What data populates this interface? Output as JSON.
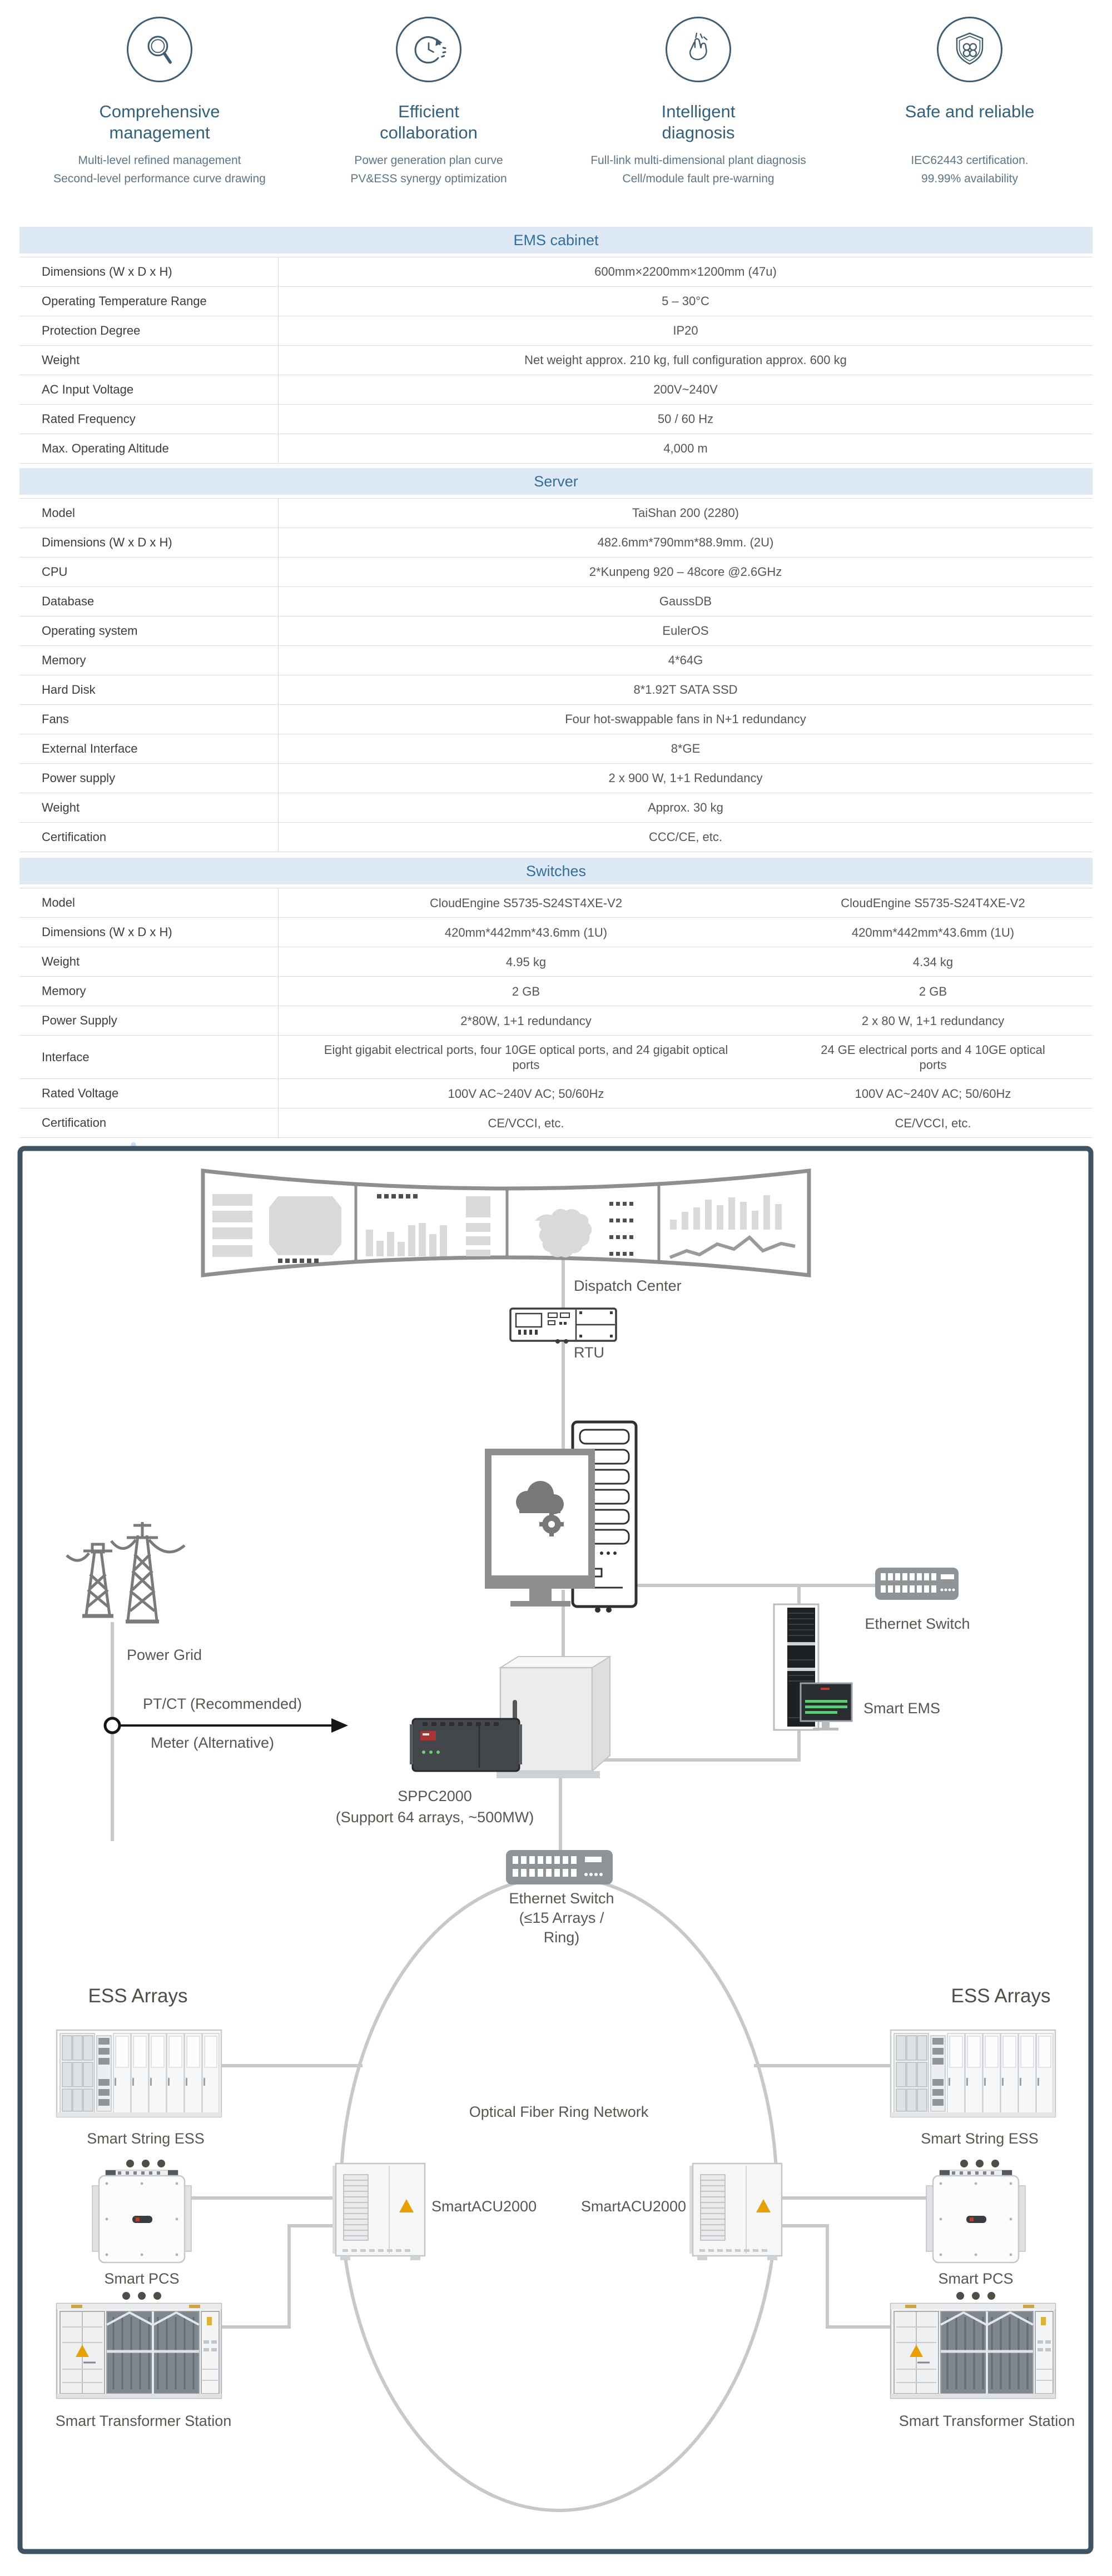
{
  "features": [
    {
      "icon": "magnifier-icon",
      "title1": "Comprehensive",
      "title2": "management",
      "desc1": "Multi-level refined management",
      "desc2": "Second-level performance curve drawing"
    },
    {
      "icon": "cycle-clock-icon",
      "title1": "Efficient",
      "title2": "collaboration",
      "desc1": "Power generation plan curve",
      "desc2": "PV&ESS synergy optimization"
    },
    {
      "icon": "snap-finger-icon",
      "title1": "Intelligent",
      "title2": "diagnosis",
      "desc1": "Full-link multi-dimensional plant diagnosis",
      "desc2": "Cell/module fault pre-warning"
    },
    {
      "icon": "shield-icon",
      "title1": "Safe and reliable",
      "title2": "",
      "desc1": "IEC62443 certification.",
      "desc2": "99.99% availability"
    }
  ],
  "tables": {
    "ems": {
      "title": "EMS cabinet",
      "rows": [
        {
          "label": "Dimensions (W x D x H)",
          "value": "600mm×2200mm×1200mm (47u)"
        },
        {
          "label": "Operating Temperature Range",
          "value": "5 – 30°C"
        },
        {
          "label": "Protection Degree",
          "value": "IP20"
        },
        {
          "label": "Weight",
          "value": "Net weight approx. 210 kg, full configuration approx. 600 kg"
        },
        {
          "label": "AC Input Voltage",
          "value": "200V~240V"
        },
        {
          "label": "Rated Frequency",
          "value": "50 / 60 Hz"
        },
        {
          "label": "Max. Operating Altitude",
          "value": "4,000 m"
        }
      ]
    },
    "server": {
      "title": "Server",
      "rows": [
        {
          "label": "Model",
          "value": "TaiShan 200 (2280)"
        },
        {
          "label": "Dimensions (W x D x H)",
          "value": "482.6mm*790mm*88.9mm. (2U)"
        },
        {
          "label": "CPU",
          "value": "2*Kunpeng 920 – 48core @2.6GHz"
        },
        {
          "label": "Database",
          "value": "GaussDB"
        },
        {
          "label": "Operating system",
          "value": "EulerOS"
        },
        {
          "label": "Memory",
          "value": "4*64G"
        },
        {
          "label": "Hard Disk",
          "value": "8*1.92T SATA SSD"
        },
        {
          "label": "Fans",
          "value": "Four hot-swappable fans in N+1 redundancy"
        },
        {
          "label": "External Interface",
          "value": "8*GE"
        },
        {
          "label": "Power supply",
          "value": "2 x 900 W, 1+1 Redundancy"
        },
        {
          "label": "Weight",
          "value": "Approx. 30 kg"
        },
        {
          "label": "Certification",
          "value": "CCC/CE, etc."
        }
      ]
    },
    "switches": {
      "title": "Switches",
      "rows": [
        {
          "label": "Model",
          "v1": "CloudEngine S5735-S24ST4XE-V2",
          "v2": "CloudEngine S5735-S24T4XE-V2"
        },
        {
          "label": "Dimensions (W x D x H)",
          "v1": "420mm*442mm*43.6mm (1U)",
          "v2": "420mm*442mm*43.6mm (1U)"
        },
        {
          "label": "Weight",
          "v1": "4.95 kg",
          "v2": "4.34 kg"
        },
        {
          "label": "Memory",
          "v1": "2 GB",
          "v2": "2 GB"
        },
        {
          "label": "Power Supply",
          "v1": "2*80W, 1+1 redundancy",
          "v2": "2 x 80 W, 1+1 redundancy"
        },
        {
          "label": "Interface",
          "v1": "Eight gigabit electrical ports, four 10GE optical ports, and 24 gigabit optical ports",
          "v2": "24 GE electrical ports and 4 10GE optical ports"
        },
        {
          "label": "Rated Voltage",
          "v1": "100V AC~240V AC; 50/60Hz",
          "v2": "100V AC~240V AC; 50/60Hz"
        },
        {
          "label": "Certification",
          "v1": "CE/VCCI, etc.",
          "v2": "CE/VCCI, etc."
        }
      ]
    }
  },
  "diagram": {
    "dispatch_center": "Dispatch Center",
    "rtu": "RTU",
    "power_grid": "Power Grid",
    "ptct": "PT/CT (Recommended)",
    "meter": "Meter (Alternative)",
    "sppc_line1": "SPPC2000",
    "sppc_line2": "(Support 64 arrays, ~500MW)",
    "eth_switch_right": "Ethernet Switch",
    "smart_ems": "Smart EMS",
    "eth_bottom_1": "Ethernet Switch",
    "eth_bottom_2": "(≤15 Arrays /",
    "eth_bottom_3": "Ring)",
    "ring": "Optical Fiber Ring Network",
    "acu_left": "SmartACU2000",
    "acu_right": "SmartACU2000",
    "ess_arrays_left": "ESS Arrays",
    "ess_arrays_right": "ESS Arrays",
    "string_ess_left": "Smart String ESS",
    "string_ess_right": "Smart String ESS",
    "pcs_left": "Smart PCS",
    "pcs_right": "Smart PCS",
    "trafo_left": "Smart Transformer Station",
    "trafo_right": "Smart Transformer Station"
  },
  "colors": {
    "table_header_bg": "#dde9f4",
    "table_header_text": "#336e9e",
    "feature_heading": "#33607e",
    "feature_desc": "#5f7484",
    "diagram_border": "#3f5363",
    "connector_gray": "#c8c8c8",
    "warning_orange": "#e8a000",
    "screen_green": "#64c878",
    "accent_blue_swoosh": "#c9ddf0"
  }
}
